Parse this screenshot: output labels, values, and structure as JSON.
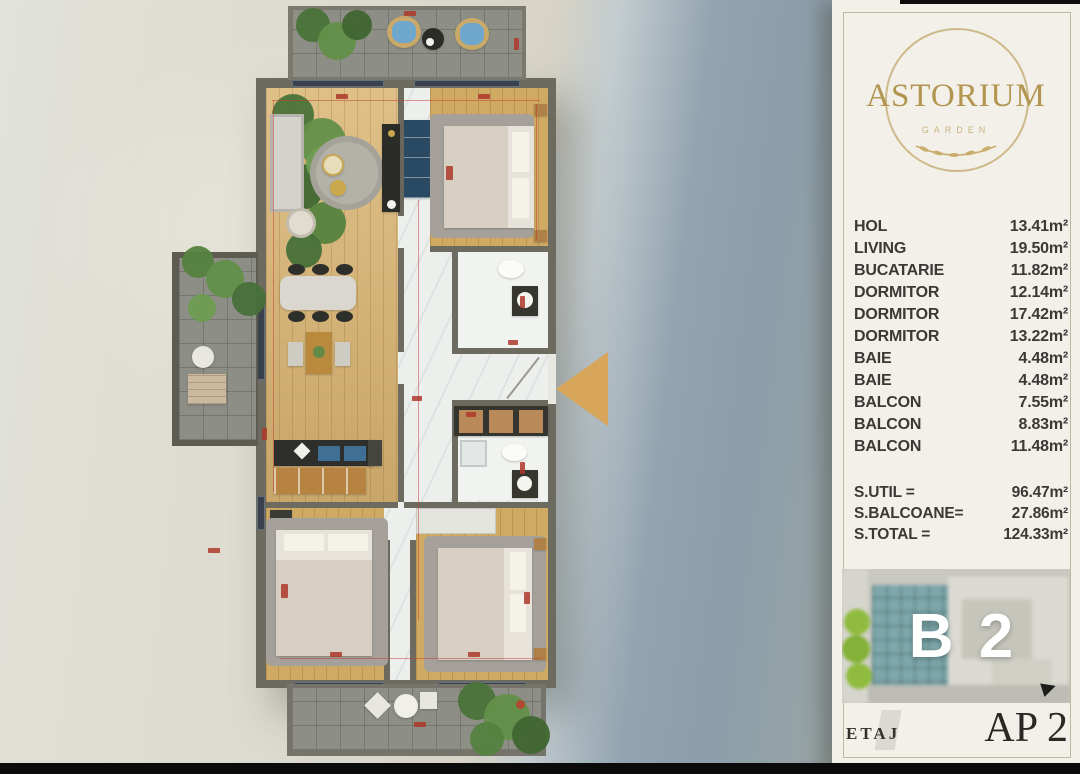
{
  "panel": {
    "logo": {
      "title": "ASTORIUM",
      "subtitle": "GARDEN"
    },
    "rooms": [
      {
        "label": "HOL",
        "value": "13.41m²"
      },
      {
        "label": "LIVING",
        "value": "19.50m²"
      },
      {
        "label": "BUCATARIE",
        "value": "11.82m²"
      },
      {
        "label": "DORMITOR",
        "value": "12.14m²"
      },
      {
        "label": "DORMITOR",
        "value": "17.42m²"
      },
      {
        "label": "DORMITOR",
        "value": "13.22m²"
      },
      {
        "label": "BAIE",
        "value": "4.48m²"
      },
      {
        "label": "BAIE",
        "value": "4.48m²"
      },
      {
        "label": "BALCON",
        "value": "7.55m²"
      },
      {
        "label": "BALCON",
        "value": "8.83m²"
      },
      {
        "label": "BALCON",
        "value": "11.48m²"
      }
    ],
    "totals": [
      {
        "label": "S.UTIL =",
        "value": "96.47m²"
      },
      {
        "label": "S.BALCOANE=",
        "value": "27.86m²"
      },
      {
        "label": "S.TOTAL =",
        "value": "124.33m²"
      }
    ],
    "unit_code": "B 2",
    "floor_label": "ETAJ",
    "apartment_label": "AP 2"
  },
  "colors": {
    "logo_gold": "#b2954f",
    "entrance_arrow": "#d7a65a",
    "card_background": "#f2f0e9",
    "list_text": "#3a3936",
    "unit_code_text": "#ffffff",
    "dimension_red": "#c23b2e"
  }
}
